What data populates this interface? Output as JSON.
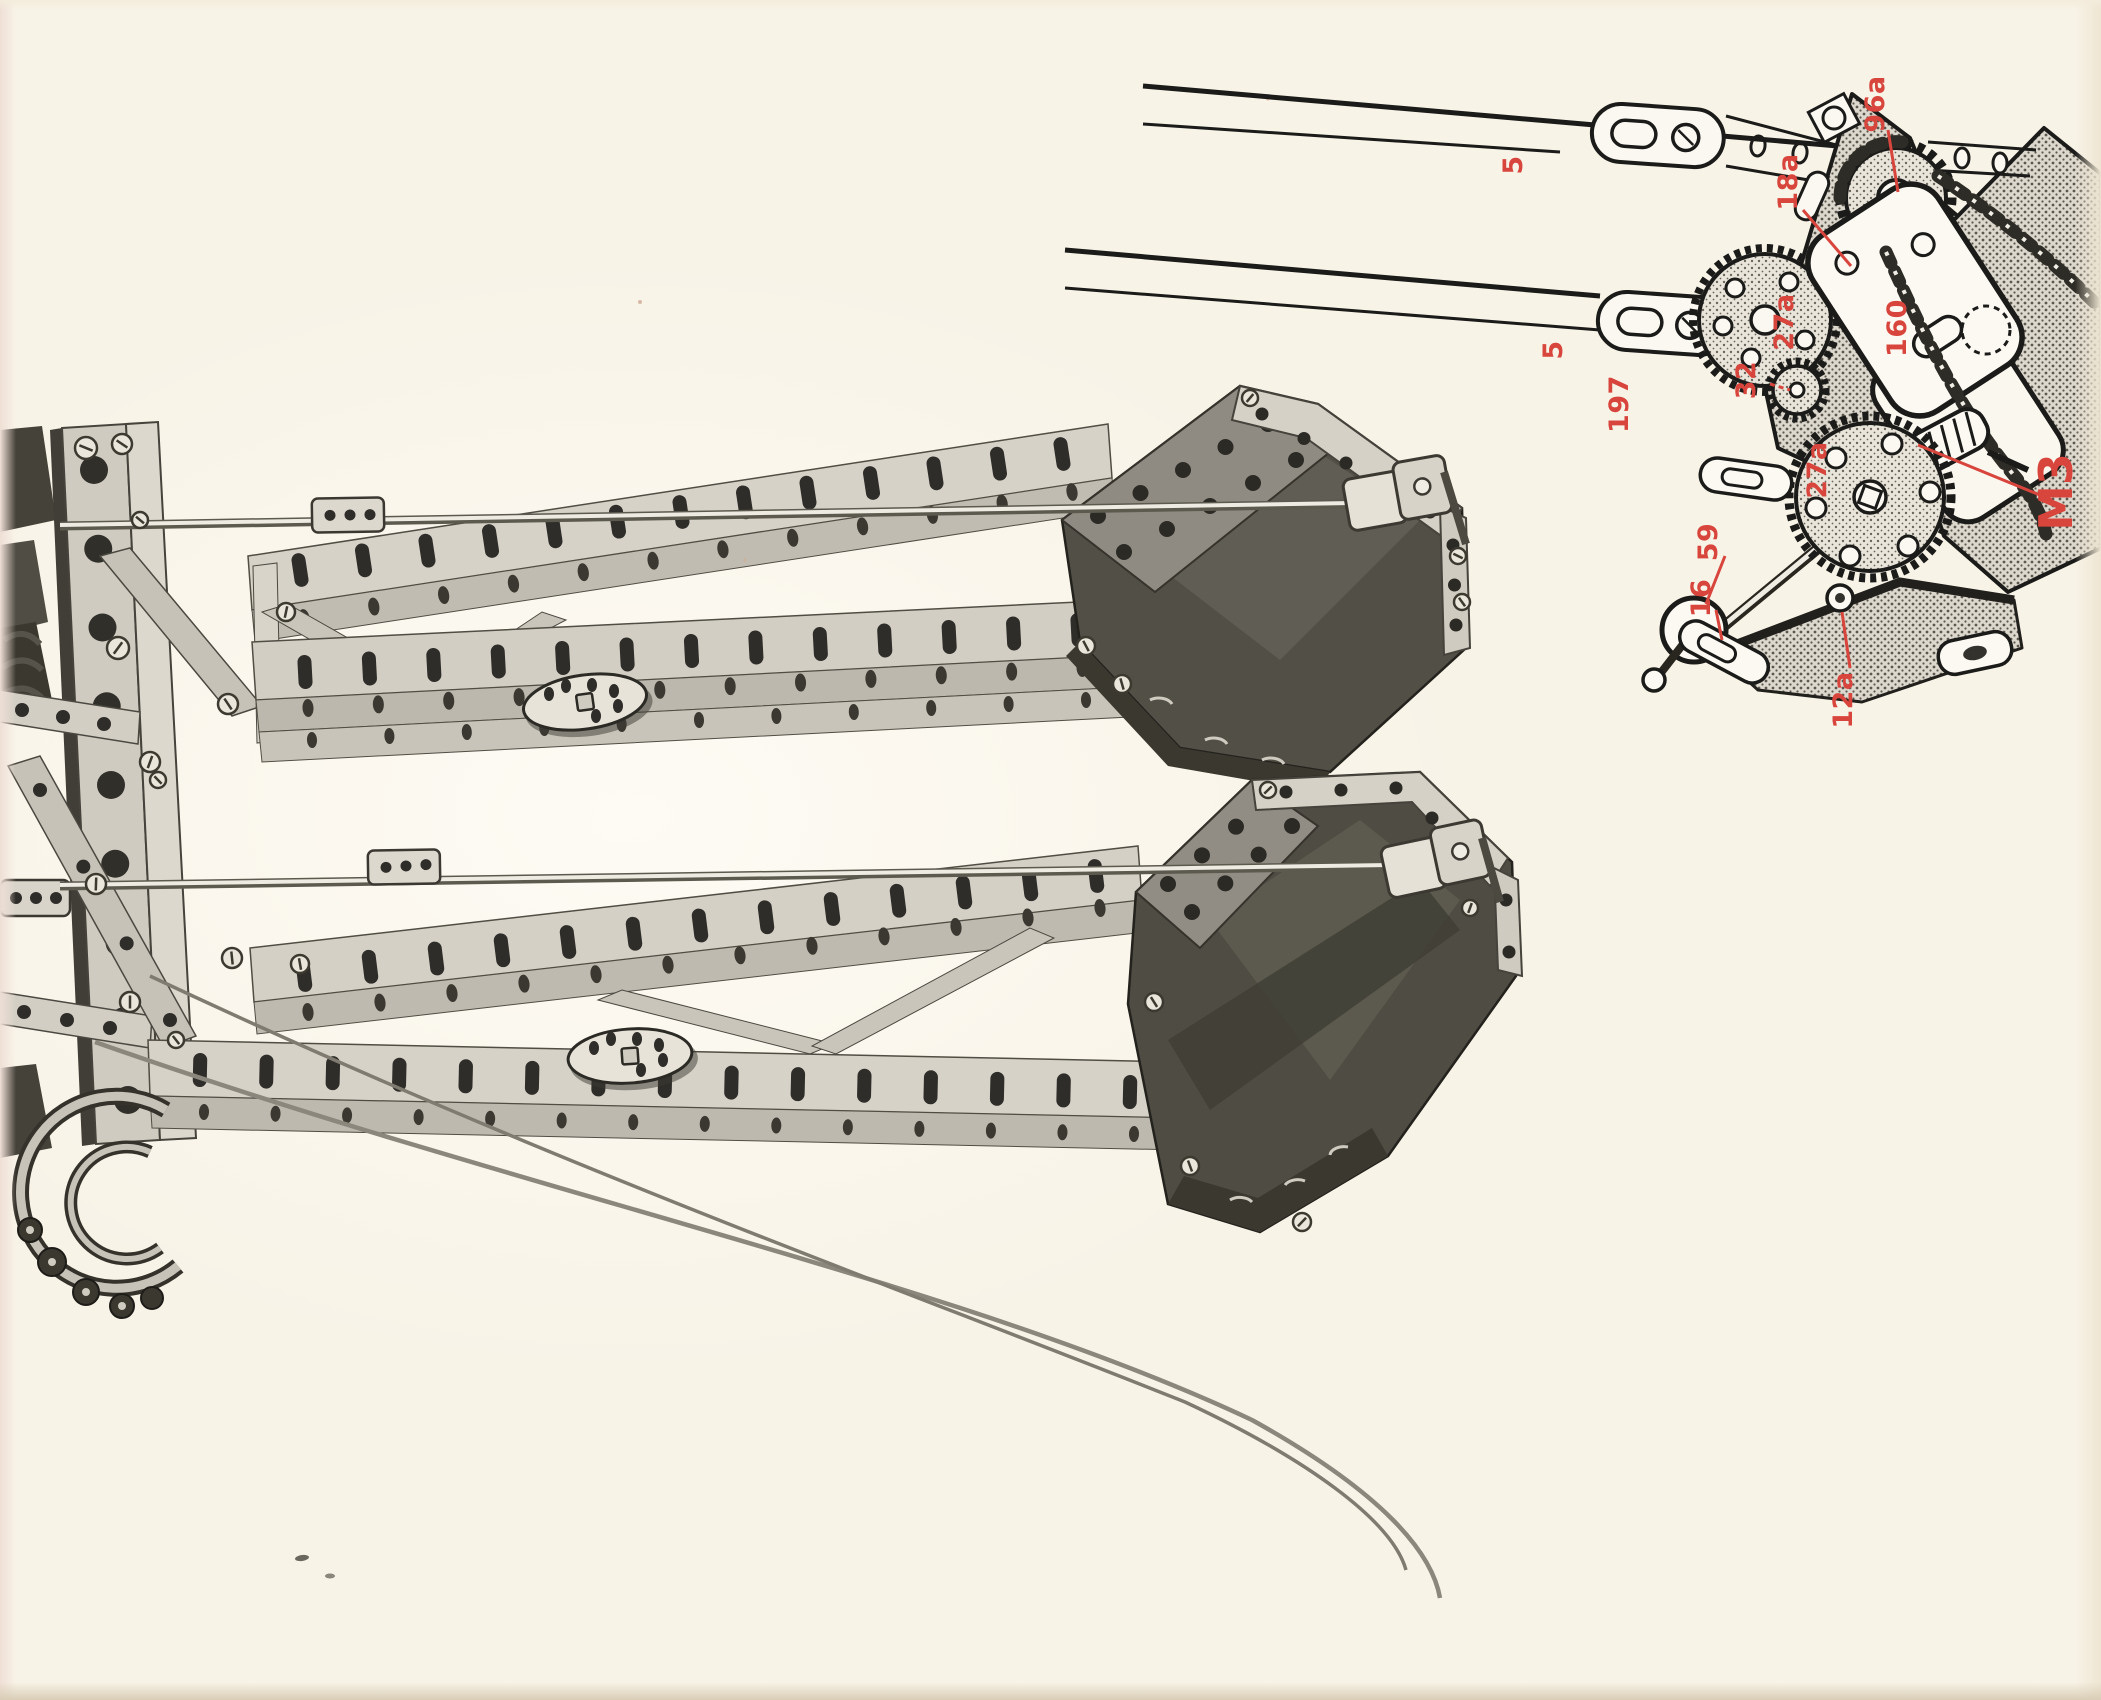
{
  "page": {
    "paper_color": "#f8f3e7",
    "accent_red": "#d8453c"
  },
  "diagram": {
    "part_labels": [
      {
        "id": "strip-upper",
        "text": "5"
      },
      {
        "id": "sprocket",
        "text": "96a"
      },
      {
        "id": "pivot-bolt",
        "text": "18a"
      },
      {
        "id": "strip-lower",
        "text": "5"
      },
      {
        "id": "long-strip",
        "text": "197"
      },
      {
        "id": "gear-upper",
        "text": "27a"
      },
      {
        "id": "bracket",
        "text": "160"
      },
      {
        "id": "pinion",
        "text": "32"
      },
      {
        "id": "gear-lower",
        "text": "27a"
      },
      {
        "id": "crank-bush",
        "text": "59"
      },
      {
        "id": "lug-strip",
        "text": "16"
      },
      {
        "id": "bolt",
        "text": "12a"
      },
      {
        "id": "motor",
        "text": "M3"
      }
    ]
  }
}
